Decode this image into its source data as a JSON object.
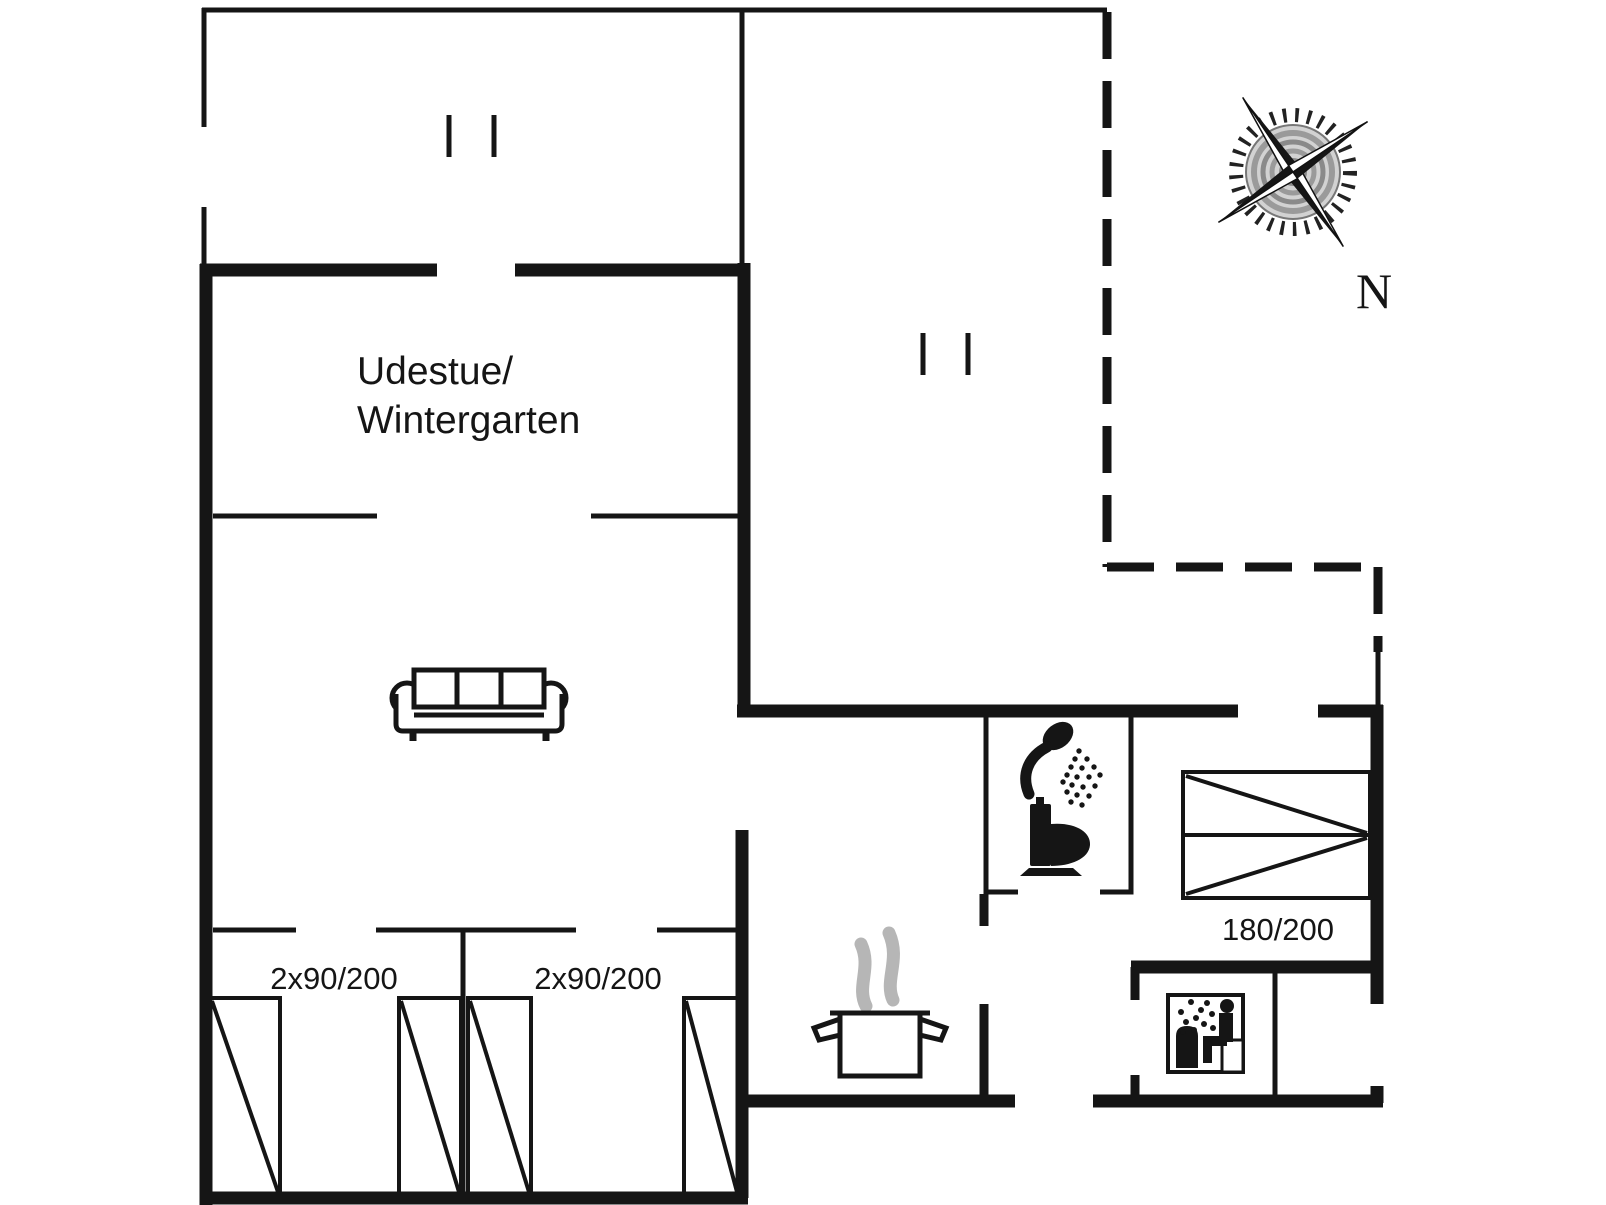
{
  "document": {
    "type": "floor-plan-drawing",
    "width_px": 1606,
    "height_px": 1205
  },
  "colors": {
    "background": "#ffffff",
    "line": "#151515",
    "steam": "#b6b6b6",
    "compass-disc": "#d2d2d2"
  },
  "floorplan": {
    "conservatory_label_line1": "Udestue/",
    "conservatory_label_line2": "Wintergarten",
    "bedroom_left_beds_label": "2x90/200",
    "bedroom_right_beds_label": "2x90/200",
    "double_bed_size_label": "180/200",
    "compass_north_label": "N"
  }
}
